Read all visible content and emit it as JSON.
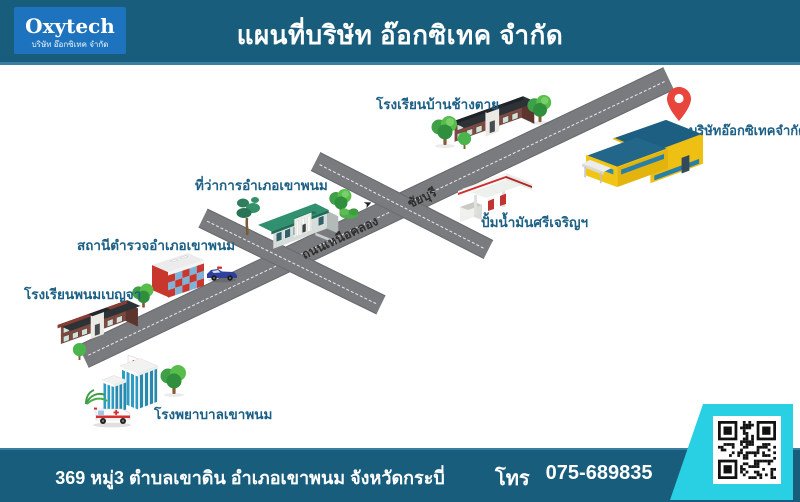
{
  "header": {
    "logo": {
      "name": "Oxytech",
      "subtitle": "บริษัท อ๊อกซิเทค จำกัด"
    },
    "title": "แผนที่บริษัท อ๊อกซิเทค จำกัด"
  },
  "map": {
    "places": [
      {
        "id": "ban-chang-tai-school",
        "label": "โรงเรียนบ้านช้างตาย"
      },
      {
        "id": "oxytech-company",
        "label": "บริษัทอ๊อกซิเทคจำกัด"
      },
      {
        "id": "district-office",
        "label": "ที่ว่าการอำเภอเขาพนม"
      },
      {
        "id": "gas-station",
        "label": "ปั้มน้ำมันศรีเจริญฯ"
      },
      {
        "id": "police-station",
        "label": "สถานีตำรวจอำเภอเขาพนม"
      },
      {
        "id": "phanom-benja-school",
        "label": "โรงเรียนพนมเบญจา"
      },
      {
        "id": "hospital",
        "label": "โรงพยาบาลเขาพนม"
      }
    ],
    "roads": [
      {
        "name": "ถนนเหนือคลอง"
      },
      {
        "name": "ชัยบุรี"
      }
    ],
    "direction_arrow": "➤"
  },
  "footer": {
    "address": "369 หมู่3 ตำบลเขาดิน อำเภอเขาพนม จังหวัดกระบี่",
    "phone_label": "โทร",
    "phone": "075-689835"
  },
  "colors": {
    "header_bg": "#195d7d",
    "footer_bg": "#195d7d",
    "divider": "#3a7fa1",
    "logo_bg": "#1d73bd",
    "accent": "#29d0e4",
    "label_blue": "#1c6085",
    "road_gray": "#797b7e",
    "road_edge": "#686a6d",
    "road_text": "#2e2e2e",
    "pin_red": "#e8453c",
    "company_yellow": "#edc013",
    "company_roof_blue": "#1d5e83"
  }
}
